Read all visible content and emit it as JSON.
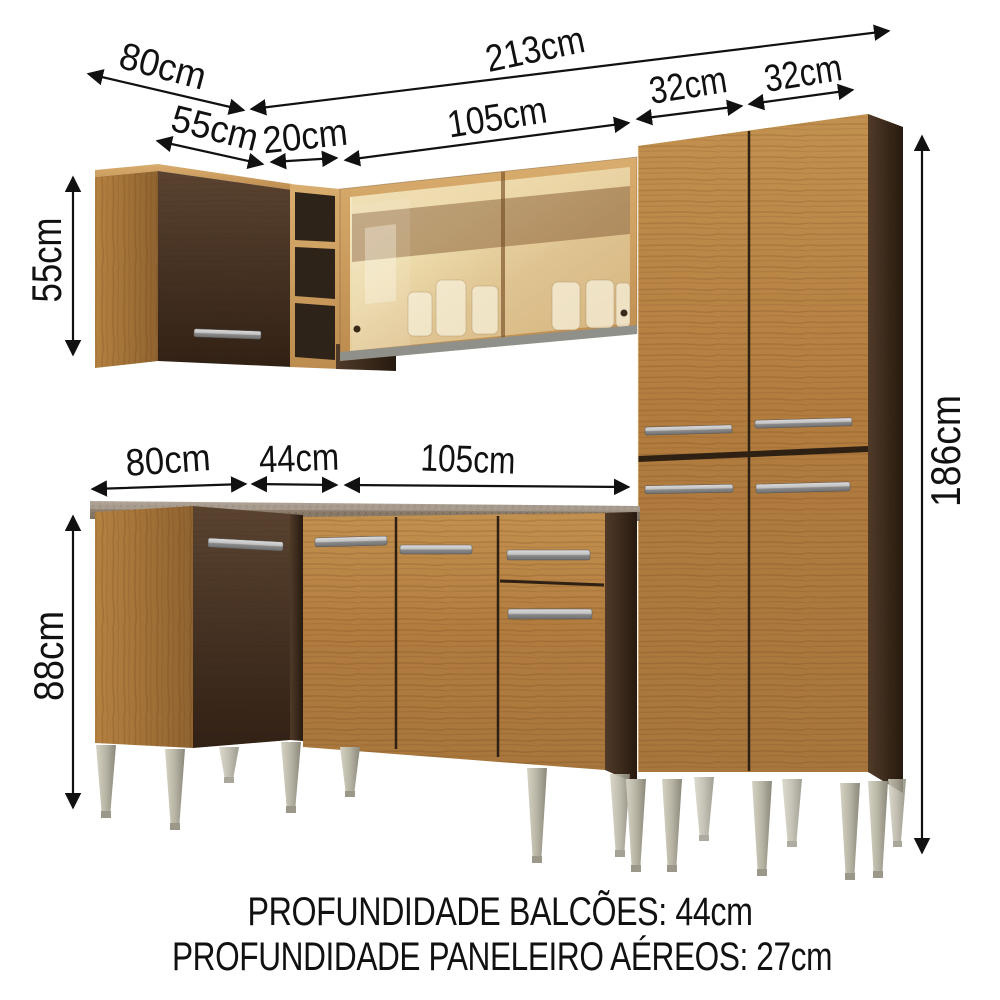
{
  "dims": {
    "top_side_80": "80cm",
    "top_total_213": "213cm",
    "top_corner_55": "55cm",
    "top_shelf_20": "20cm",
    "top_glass_105": "105cm",
    "top_pantry_32a": "32cm",
    "top_pantry_32b": "32cm",
    "left_upper_55": "55cm",
    "left_base_88": "88cm",
    "right_pantry_186": "186cm",
    "mid_side_80": "80cm",
    "mid_corner_44": "44cm",
    "mid_counter_105": "105cm"
  },
  "footer": {
    "line1": "PROFUNDIDADE BALCÕES: 44cm",
    "line2": "PROFUNDIDADE PANELEIRO AÉREOS: 27cm"
  },
  "colors": {
    "background": "#ffffff",
    "annotation": "#111111",
    "wood_light": "#b9854a",
    "wood_light_deep": "#9e6f35",
    "wood_dark": "#4a3524",
    "wood_dark_deep": "#2f2113",
    "countertop": "#8e8070",
    "glass_tint": "#e9d5a5",
    "handle_metal": "#bdbdbd",
    "leg_metal": "#b4b1a1"
  }
}
